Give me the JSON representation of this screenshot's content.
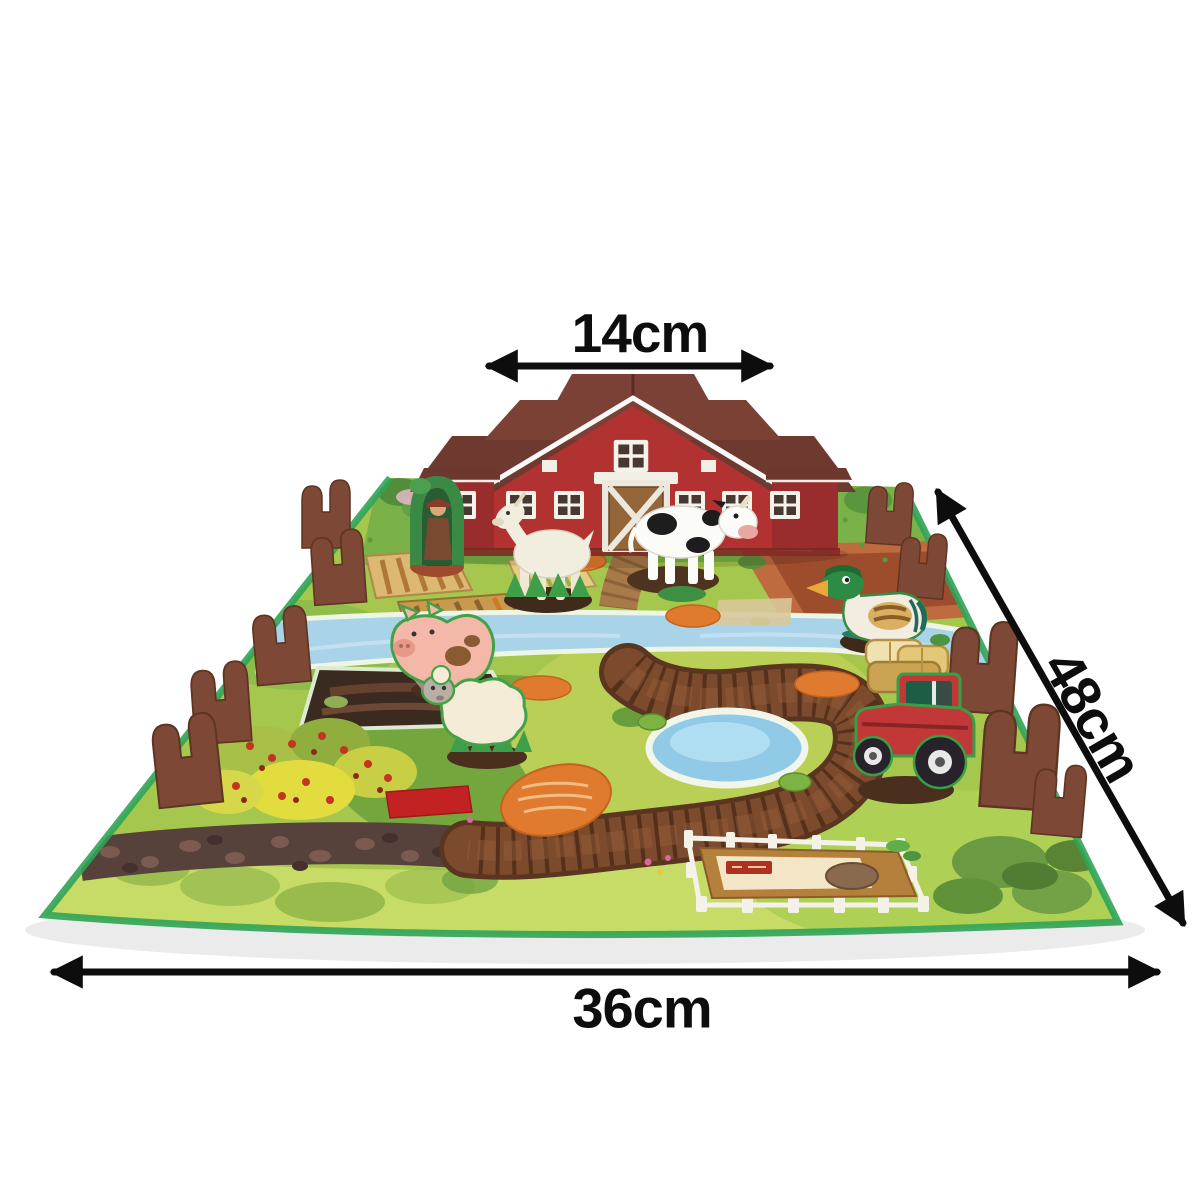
{
  "measurements": {
    "barn_width": "14cm",
    "mat_depth": "48cm",
    "mat_width": "36cm"
  },
  "style": {
    "background_color": "#ffffff",
    "annotation_color": "#0d0d0d",
    "mat_green": "#a6c74d",
    "mat_edge_green": "#2fa457",
    "barn_red": "#b23232",
    "barn_wing_red": "#992c2c",
    "roof_brown": "#7a4134",
    "fence_brown": "#7d4836",
    "river_blue": "#a9d3e8",
    "pond_blue": "#90cae6",
    "path_brown": "#7c4a2c"
  },
  "scene_items": [
    "play-mat",
    "red-barn",
    "farmer-figure",
    "goat-figure",
    "cow-figure",
    "pig-figure",
    "sheep-figure",
    "duck-figure",
    "tractor-figure",
    "hay-bales",
    "river",
    "wooden-bridge",
    "pond",
    "winding-plank-path",
    "cobblestone-path",
    "mud-pit",
    "berry-bushes",
    "crop-fields",
    "plowed-field",
    "feeding-pen",
    "fence-pieces"
  ]
}
